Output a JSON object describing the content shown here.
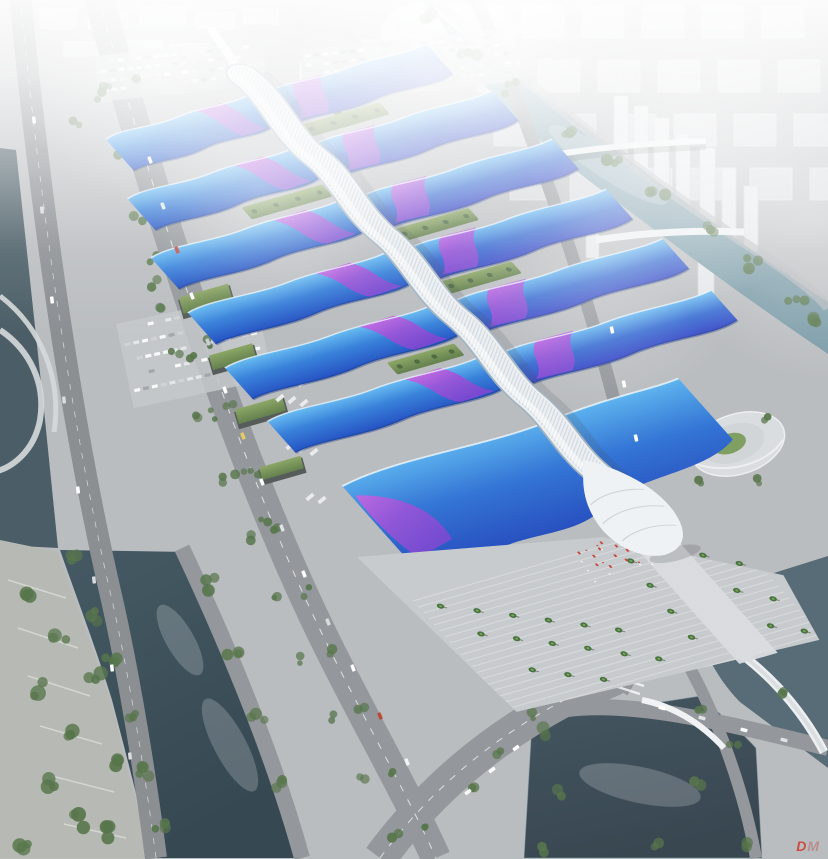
{
  "image": {
    "type": "architectural-aerial-rendering",
    "subject": "riverside exhibition and convention center with wave-form blue roofs, purple ribbon stripes and a white ribbed central pedestrian spine",
    "watermark": {
      "primary": "D",
      "secondary": "M"
    }
  },
  "complex": {
    "hall_rows": 6,
    "halls_per_row": 2,
    "south_hall": "large wave-roof entrance hall with white shell canopy",
    "plaza": "terraced palm plaza with red flags"
  },
  "palette": {
    "fog": "#f2f4f6",
    "ground": "#b7babd",
    "ground_light": "#c6c9cc",
    "road": "#8f9397",
    "road_dark": "#85898d",
    "roof_cyan": "#63bbf2",
    "roof_blue": "#2f7cd9",
    "roof_deep": "#1a49c0",
    "roof_indigo": "#2f3ec4",
    "ribbon_magenta": "#cd5ae0",
    "ribbon_purple": "#7b3fd0",
    "spine_white": "#ecf0f3",
    "shell_white": "#eef2f5",
    "water_river": "#3b515c",
    "water_river_deep": "#2c3f49",
    "water_pond": "#2f3e48",
    "water_canal": "#7496a3",
    "water_edge": "#4e6570",
    "lawn": "#7a9a5a",
    "tree": "#4f6f42",
    "palm": "#3f6b34",
    "entry_red": "#c43b2e",
    "city_block": "#d5d8db",
    "tower_white": "#e2e5e8",
    "bridge_white": "#eceff1",
    "watermark_red": "#cf3a2e",
    "watermark_gray": "#b7706a"
  }
}
